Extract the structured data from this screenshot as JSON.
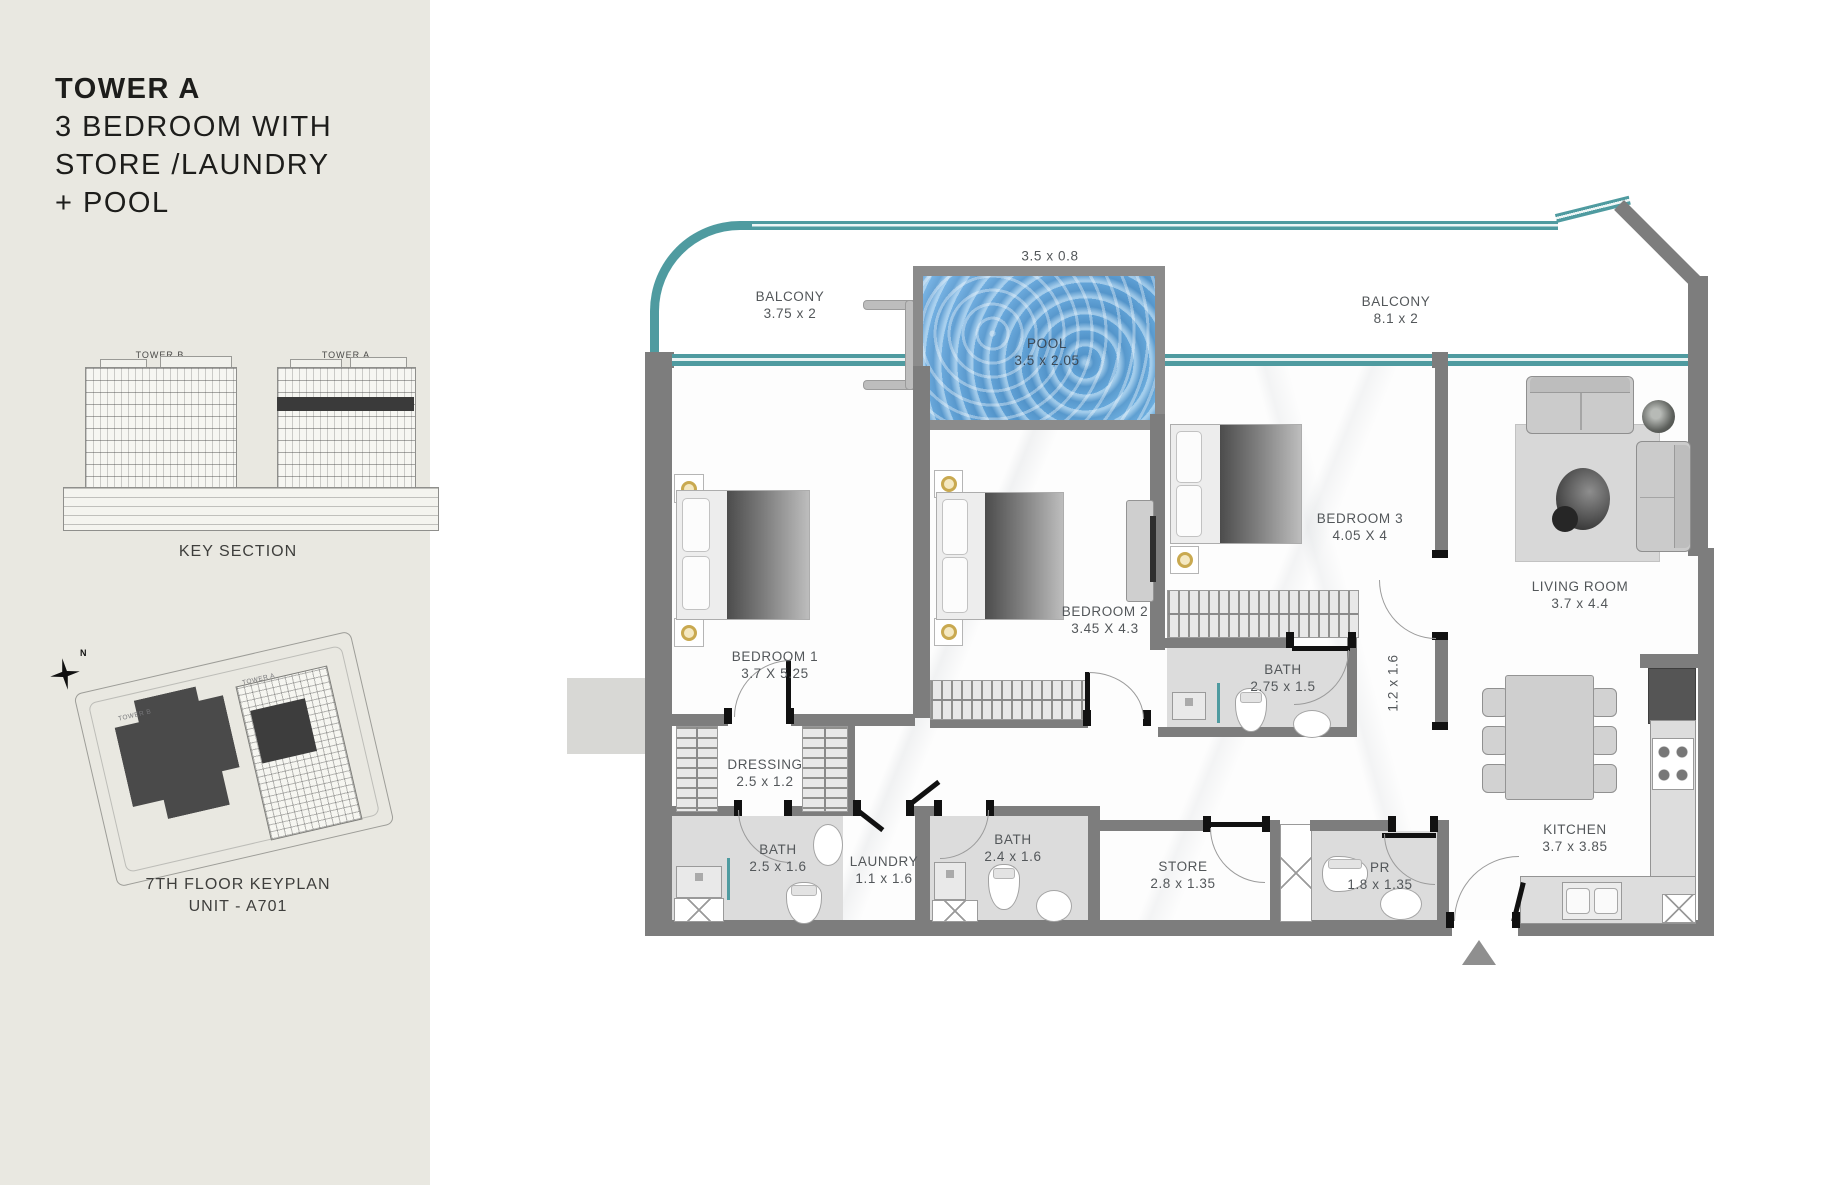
{
  "sidebar": {
    "title": {
      "line1": "TOWER A",
      "line2": "3 BEDROOM WITH",
      "line3": "STORE /LAUNDRY",
      "line4": "+ POOL"
    },
    "key_section": {
      "tower_b": "TOWER B",
      "tower_a": "TOWER A",
      "caption": "KEY SECTION"
    },
    "compass": {
      "north": "N"
    },
    "keyplan": {
      "tower_b": "TOWER B",
      "tower_a": "TOWER A",
      "caption_line1": "7TH FLOOR KEYPLAN",
      "caption_line2": "UNIT - A701"
    }
  },
  "floorplan": {
    "rooms": {
      "balcony_left": {
        "name": "BALCONY",
        "dim": "3.75 x 2"
      },
      "balcony_right": {
        "name": "BALCONY",
        "dim": "8.1 x 2"
      },
      "pool": {
        "name": "POOL",
        "dim": "3.5 x 2.05"
      },
      "bedroom1": {
        "name": "BEDROOM 1",
        "dim": "3.7 X 5.25"
      },
      "bedroom2": {
        "name": "BEDROOM 2",
        "dim": "3.45 X 4.3"
      },
      "bedroom3": {
        "name": "BEDROOM 3",
        "dim": "4.05 X 4"
      },
      "living_room": {
        "name": "LIVING ROOM",
        "dim": "3.7 x 4.4"
      },
      "bath3": {
        "name": "BATH",
        "dim": "2.75 x 1.5"
      },
      "dressing": {
        "name": "DRESSING",
        "dim": "2.5 x 1.2"
      },
      "bath1": {
        "name": "BATH",
        "dim": "2.5 x 1.6"
      },
      "laundry": {
        "name": "LAUNDRY",
        "dim": "1.1 x 1.6"
      },
      "bath2": {
        "name": "BATH",
        "dim": "2.4 x 1.6"
      },
      "store": {
        "name": "STORE",
        "dim": "2.8 x 1.35"
      },
      "pr": {
        "name": "PR",
        "dim": "1.8 x 1.35"
      },
      "kitchen": {
        "name": "KITCHEN",
        "dim": "3.7 x 3.85"
      }
    },
    "dimensions": {
      "pool_deck": "3.5 x 0.8",
      "corridor": "1.2 x 1.6"
    },
    "colors": {
      "teal": "#4f9ba0",
      "wall": "#7d7d7d",
      "pool_water": "#6aaede",
      "sidebar_bg": "#e9e8e1",
      "unit_highlight": "#3d3d3d"
    }
  }
}
